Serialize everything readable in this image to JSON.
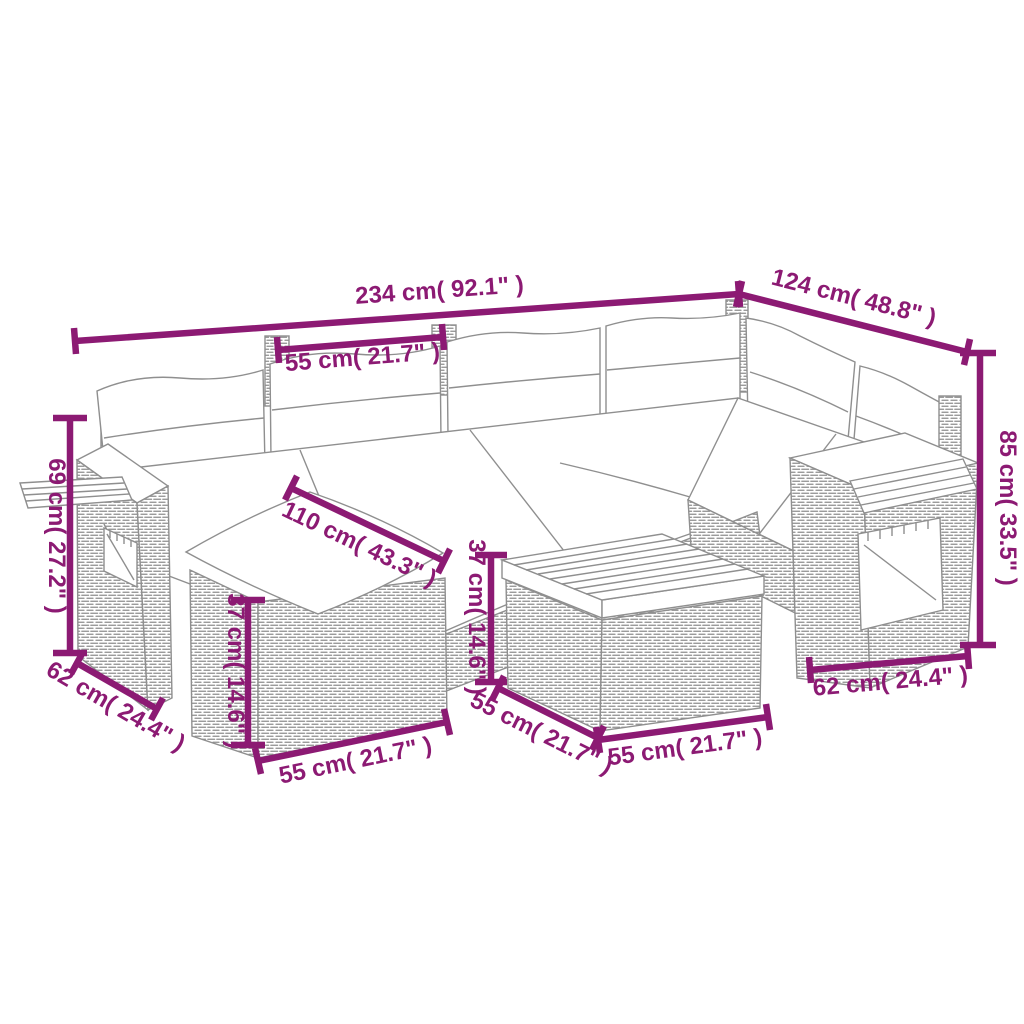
{
  "figure": {
    "kind": "product dimension diagram",
    "subject": "rattan garden lounge set with ottoman and coffee table",
    "accent_color": "#8C1A73",
    "line_art_color": "#8F8F8F"
  },
  "dims": {
    "overall_width": "234 cm( 92.1\" )",
    "right_depth": "124 cm( 48.8\" )",
    "seat_width_top": "55 cm( 21.7\" )",
    "back_height": "85 cm( 33.5\" )",
    "arm_height": "69 cm( 27.2\" )",
    "seat_ottoman_depth": "110 cm( 43.3\" )",
    "ottoman_height": "37 cm( 14.6\" )",
    "ottoman_width": "55 cm( 21.7\" )",
    "left_seat_depth": "62 cm( 24.4\" )",
    "table_height": "37 cm( 14.6\" )",
    "table_depth": "55 cm( 21.7\" )",
    "table_width": "55 cm( 21.7\" )",
    "right_seat_depth": "62 cm( 24.4\" )"
  }
}
